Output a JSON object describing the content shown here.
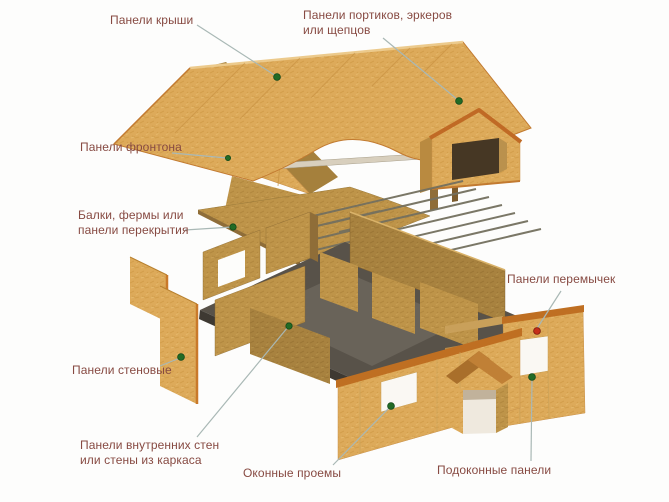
{
  "diagram": {
    "subject": "Exploded axonometric diagram of a SIP-panel house showing building components",
    "language": "ru"
  },
  "labels": {
    "roof_panels": {
      "text": "Панели крыши",
      "marker": "green"
    },
    "portico_panels": {
      "text": "Панели портиков, эркеров или щепцов",
      "marker": "green"
    },
    "gable_panels": {
      "text": "Панели фронтона",
      "marker": "green"
    },
    "floor_beams": {
      "text": "Балки, фермы или панели перекрытия",
      "marker": "green"
    },
    "lintel_panels": {
      "text": "Панели перемычек",
      "marker": "red"
    },
    "wall_panels": {
      "text": "Панели стеновые",
      "marker": "green"
    },
    "interior_wall_panels": {
      "text": "Панели внутренних стен или стены из каркаса",
      "marker": "green"
    },
    "window_openings": {
      "text": "Оконные проемы",
      "marker": "green"
    },
    "sill_panels": {
      "text": "Подоконные панели",
      "marker": "green"
    }
  },
  "colors": {
    "label_text": "#874a42",
    "leader_line": "#a9b8b5",
    "marker_green": "#226b25",
    "marker_green_ring": "#12491a",
    "marker_red": "#c52f1a",
    "marker_red_ring": "#7a1a0e",
    "panel_face": "#dcaa58",
    "panel_edge_orange": "#bf6f22",
    "panel_dark": "#a8823f",
    "slab_gray": "#585249",
    "background": "#fdfdfc"
  }
}
